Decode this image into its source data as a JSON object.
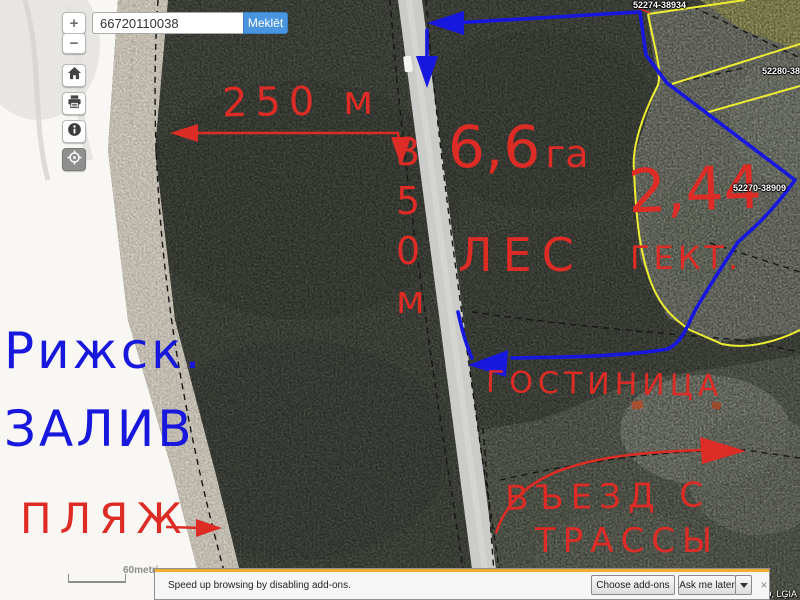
{
  "colors": {
    "annotation_red": "#dd2b25",
    "annotation_blue": "#1717dd",
    "accent_blue": "#4a95e0",
    "parcel_yellow": "#eded34",
    "notify_stripe": "#efae2d"
  },
  "zoom_controls": {
    "zoom_in": "+",
    "zoom_out": "−"
  },
  "search": {
    "value": "66720110038",
    "button_label": "Meklēt"
  },
  "sidebar": {
    "tools": [
      "home",
      "print",
      "info",
      "locate"
    ]
  },
  "map": {
    "parcel_labels": [
      {
        "text": "52274-38934"
      },
      {
        "text": "52280-3892"
      },
      {
        "text": "52270-38909"
      }
    ],
    "scale_label": "60metri",
    "attribution": "D, LĢIA"
  },
  "annotations": {
    "width_measure": "250 м",
    "height_measure": "3 5 0 м",
    "forest_area_value": "6,6",
    "forest_area_unit": "га",
    "forest_label": "ЛЕС",
    "field_area_value": "2,44",
    "field_area_unit": "ГЕКТ.",
    "gulf_line1": "Рижск.",
    "gulf_line2": "ЗАЛИВ",
    "beach_label": "ПЛЯЖ",
    "hotel_label": "ГОСТИНИЦА",
    "entrance_line1": "ВЪЕЗД С",
    "entrance_line2": "ТРАССЫ"
  },
  "notification": {
    "message": "Speed up browsing by disabling add-ons.",
    "choose_label": "Choose add-ons",
    "later_label": "Ask me later",
    "close": "×"
  }
}
